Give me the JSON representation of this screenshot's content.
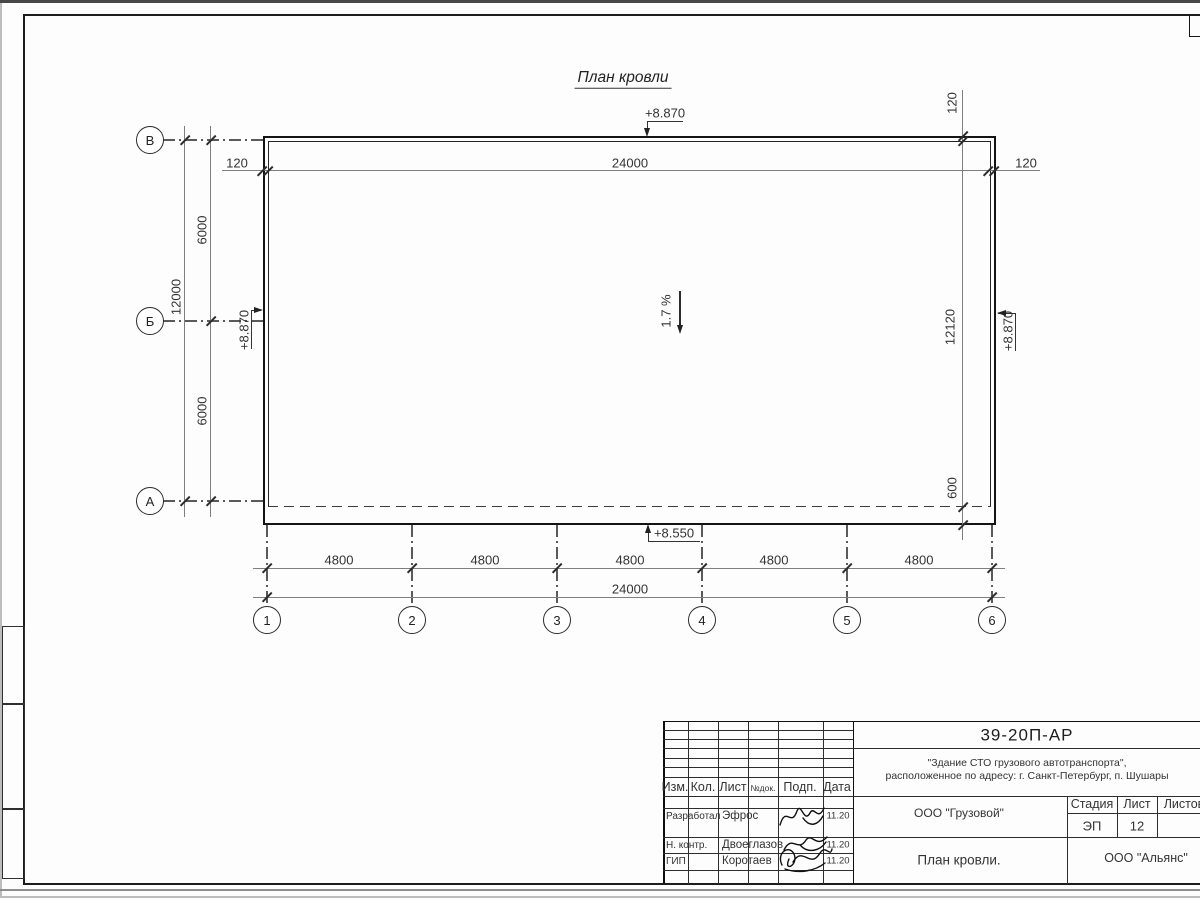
{
  "drawing": {
    "title": "План кровли",
    "slope": "1.7 %",
    "elevation_top": "+8.870",
    "elevation_left": "+8.870",
    "elevation_right": "+8.870",
    "elevation_bottom": "+8.550",
    "dim_top_offset_left": "120",
    "dim_top_span": "24000",
    "dim_top_offset_right": "120",
    "dim_right_offset": "120",
    "dim_right_span": "12120",
    "dim_right_eave": "600",
    "dim_left_upper": "6000",
    "dim_left_lower": "6000",
    "dim_left_total": "12000",
    "dim_bottom_bays": [
      "4800",
      "4800",
      "4800",
      "4800",
      "4800"
    ],
    "dim_bottom_total": "24000",
    "axis_rows": [
      "В",
      "Б",
      "А"
    ],
    "axis_cols": [
      "1",
      "2",
      "3",
      "4",
      "5",
      "6"
    ]
  },
  "title_block": {
    "doc_code": "39-20П-АР",
    "object_name_line1": "\"Здание СТО грузового автотранспорта\",",
    "object_name_line2": "расположенное по адресу: г. Санкт-Петербург, п. Шушары",
    "columns": {
      "izm": "Изм.",
      "kol": "Кол.",
      "list": "Лист",
      "ndoc": "№док.",
      "podp": "Подп.",
      "data": "Дата"
    },
    "rows": [
      {
        "role": "Разработал",
        "name": "Эфрос",
        "date": "11.20"
      },
      {
        "role": "Н. контр.",
        "name": "Двоеглазов",
        "date": "11.20"
      },
      {
        "role": "ГИП",
        "name": "Коротаев",
        "date": "11.20"
      }
    ],
    "org_center": "ООО \"Грузовой\"",
    "stage": {
      "header_stage": "Стадия",
      "header_sheet": "Лист",
      "header_sheets": "Листов",
      "stage_value": "ЭП",
      "sheet_value": "12",
      "sheets_value": ""
    },
    "sheet_title": "План кровли.",
    "company": "ООО \"Альянс\""
  },
  "colors": {
    "line": "#161616",
    "dim_line": "#7e7e7e",
    "text": "#333333",
    "paper": "#fdfdfd"
  }
}
